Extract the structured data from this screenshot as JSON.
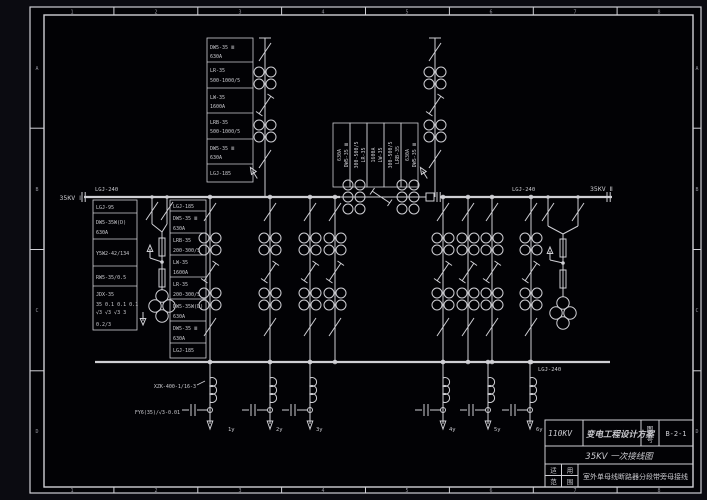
{
  "colors": {
    "background": "#0b0b11",
    "paper": "#020205",
    "line": "#cfcfd4"
  },
  "frame": {
    "letters": [
      "A",
      "B",
      "C",
      "D"
    ],
    "numbers": [
      "1",
      "2",
      "3",
      "4",
      "5",
      "6",
      "7",
      "8"
    ]
  },
  "title_block": {
    "kv": "110KV",
    "project": "变电工程设计方案",
    "no_label_1": "图",
    "no_label_2": "号",
    "number": "B-2-1",
    "sheet": "35KV  一次接线图",
    "scope_chars": [
      "适",
      "用",
      "范",
      "围"
    ],
    "scope": "室外单母线断路器分段带旁母接线"
  },
  "bus": {
    "left_conductor": "LGJ-240",
    "left_name": "35KV Ⅰ",
    "right_conductor": "LGJ-240",
    "right_name": "35KV Ⅱ",
    "bypass_conductor": "LGJ-240"
  },
  "incoming_column": [
    {
      "l1": "DW5-35 Ⅲ",
      "l2": "630A"
    },
    {
      "l1": "LR-35",
      "l2": "500-1000/5"
    },
    {
      "l1": "LW-35",
      "l2": "1600A"
    },
    {
      "l1": "LRB-35",
      "l2": "500-1000/5"
    },
    {
      "l1": "DW5-35 Ⅲ",
      "l2": "630A"
    },
    {
      "l1": "LGJ-185"
    }
  ],
  "bay_column": [
    {
      "l1": "LGJ-185"
    },
    {
      "l1": "DW5-35 Ⅲ",
      "l2": "630A"
    },
    {
      "l1": "LRB-35",
      "l2": "200-300/5"
    },
    {
      "l1": "LW-35",
      "l2": "1600A"
    },
    {
      "l1": "LR-35",
      "l2": "200-300/5"
    },
    {
      "l1": "DW5-35W(D)",
      "l2": "630A"
    },
    {
      "l1": "DW5-35 Ⅲ",
      "l2": "630A"
    },
    {
      "l1": "LGJ-185"
    }
  ],
  "pt_bay": {
    "conductor": "LGJ-95",
    "breaker": "DW5-35W(D)",
    "breaker_rating": "630A",
    "arrester": "Y5W2-42/134",
    "fuse": "RW5-35/0.5",
    "pt_model": "JDX-35",
    "ratio_top": "35 0.1 0.1 0.1",
    "ratio_bottom": "√3  √3  √3  3",
    "accuracy": "0.2/3"
  },
  "tie_column": [
    {
      "l1": "630A",
      "l2": "DW5-35 Ⅲ"
    },
    {
      "l1": "300-500/5",
      "l2": "LR-35"
    },
    {
      "l1": "1600A",
      "l2": "LW-35"
    },
    {
      "l1": "300-500/5",
      "l2": "LRB-35"
    },
    {
      "l1": "630A",
      "l2": "DW5-35 Ⅲ"
    }
  ],
  "feeders": {
    "labels": [
      "1y",
      "2y",
      "3y",
      "4y",
      "5y",
      "6y"
    ],
    "reactor": "XZK-400-1/16-3",
    "capacitor": "FY6(35)/√3-0.01"
  }
}
